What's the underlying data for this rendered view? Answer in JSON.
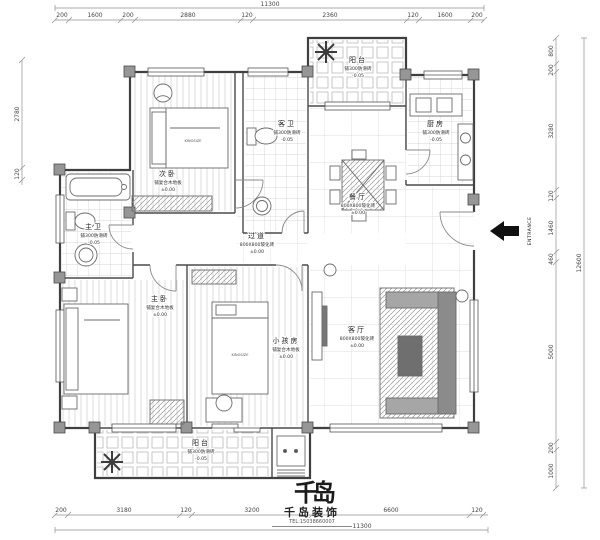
{
  "plan": {
    "rooms": [
      {
        "name": "阳台",
        "finish": "铺300防滑砖",
        "level": "-0.05"
      },
      {
        "name": "厨房",
        "finish": "铺300防滑砖",
        "level": "-0.05"
      },
      {
        "name": "餐厅",
        "finish": "800X800玻化砖",
        "level": "±0.00"
      },
      {
        "name": "客卫",
        "finish": "铺300防滑砖",
        "level": "-0.05"
      },
      {
        "name": "次卧",
        "finish": "铺复合木地板",
        "level": "±0.00"
      },
      {
        "name": "主卫",
        "finish": "铺300防滑砖",
        "level": "-0.05"
      },
      {
        "name": "过道",
        "finish": "800X800玻化砖",
        "level": "±0.00"
      },
      {
        "name": "主卧",
        "finish": "铺复合木地板",
        "level": "±0.00"
      },
      {
        "name": "小孩房",
        "finish": "铺复合木地板",
        "level": "±0.00"
      },
      {
        "name": "客厅",
        "finish": "800X800玻化砖",
        "level": "±0.00"
      },
      {
        "name": "阳台",
        "finish": "铺300防滑砖",
        "level": "-0.05"
      }
    ],
    "bed_label": "KINGSIZE",
    "entrance": "ENTRANCE"
  },
  "dims": {
    "top": {
      "overall": "11300",
      "segments": [
        "200",
        "1600",
        "200",
        "2880",
        "120",
        "2360",
        "120",
        "1600",
        "200"
      ]
    },
    "bottom": {
      "overall": "11300",
      "segments": [
        "200",
        "3180",
        "120",
        "3200",
        "6600",
        "120"
      ]
    },
    "left": {
      "segments": [
        "2780",
        "120"
      ]
    },
    "right": {
      "overall": "12600",
      "segments": [
        "800",
        "200",
        "3280",
        "120",
        "1460",
        "460",
        "5000",
        "200",
        "1000"
      ]
    }
  },
  "logo": {
    "mark": "千岛",
    "company": "千岛装饰",
    "tel": "TEL:15038660007"
  }
}
